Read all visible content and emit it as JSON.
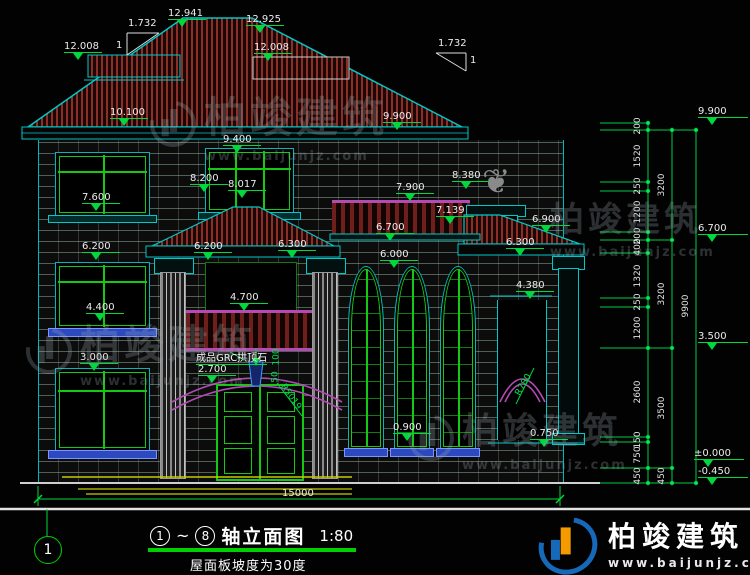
{
  "title_block": {
    "axis_start": "1",
    "tilde": "~",
    "axis_end": "8",
    "title": "轴立面图",
    "scale": "1:80",
    "note": "屋面板坡度为30度"
  },
  "axis_bubble": "1",
  "watermark": {
    "name": "柏竣建筑",
    "url": "www.baijunjz.com"
  },
  "logo": {
    "name": "柏竣建筑",
    "url": "www.baijunjz.com"
  },
  "slope": {
    "ratio": "1.732",
    "unit": "1"
  },
  "annotations": {
    "keystone": "成品GRC拱顶石",
    "entry_arch_radius": "R5019",
    "right_arch_radius": "R780",
    "keystone_width": "100",
    "keystone_height": "50"
  },
  "dims": {
    "overall_width": "15000",
    "overall_height": "9900",
    "col1": [
      "200",
      "1520",
      "250",
      "1200",
      "200",
      "400",
      "1320",
      "250",
      "1200",
      "2600",
      "150",
      "750",
      "450"
    ],
    "col2": [
      "3200",
      "3200",
      "3500",
      "450"
    ]
  },
  "elevations": [
    "12.941",
    "12.925",
    "12.008",
    "12.008",
    "10.100",
    "9.900",
    "9.400",
    "8.200",
    "8.017",
    "7.600",
    "7.900",
    "8.380",
    "7.139",
    "6.900",
    "6.700",
    "6.300",
    "6.200",
    "6.200",
    "6.300",
    "6.000",
    "4.400",
    "4.700",
    "4.380",
    "3.000",
    "2.700",
    "0.900",
    "0.750",
    "9.900",
    "6.700",
    "3.500",
    "±0.000",
    "-0.450"
  ]
}
